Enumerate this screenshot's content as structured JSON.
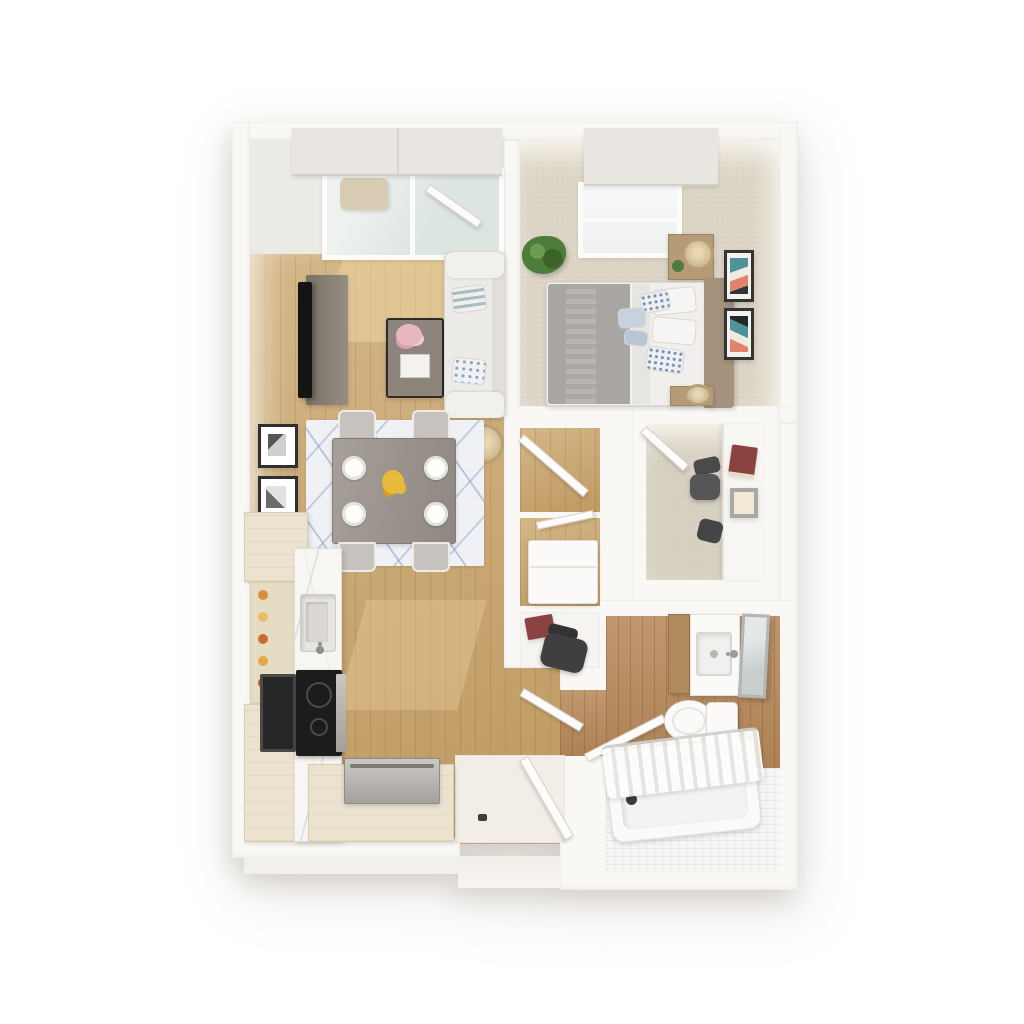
{
  "scene": {
    "type": "3d-floor-plan-render",
    "view": "top-down dollhouse",
    "background_color": "#ffffff"
  },
  "palette": {
    "wall": "#faf8f5",
    "wood_floor": "#c9a266",
    "carpet": "#ddd6c6",
    "den_carpet": "#d7d1c1",
    "bath_wood": "#b8895a",
    "tile": "#f6f6f4",
    "cabinet_cream": "#ebe3d0",
    "marble": "#f7f6f3",
    "rug": "#eff1f4",
    "rug_accent": "#9fb0cc",
    "sofa": "#edebe8",
    "console": "#8a8175",
    "tv": "#141414",
    "dining_table": "#989089",
    "blanket": "#a9a5a2",
    "headboard": "#a5937d",
    "nightstand": "#b49a76",
    "lamp": "#d2bb8f",
    "plant": "#4e7c3a",
    "flowers_dining": "#e8b93c",
    "flowers_coffee": "#e7b7c0",
    "book_red": "#8a4340",
    "art_teal": "#4f9396",
    "art_coral": "#e2836b",
    "stainless": "#b5b1ab",
    "appliance_dark": "#1c1c1c",
    "fixture_white": "#fbfaf9",
    "entry_tile": "#f2eee7",
    "balcony_floor": "#e7e6e0",
    "glass": "#e3e9e6",
    "shade": "#e9e6e2"
  },
  "rooms": [
    {
      "id": "living-room",
      "name": "Living Room",
      "floor": "hardwood"
    },
    {
      "id": "dining-area",
      "name": "Dining Area",
      "floor": "hardwood"
    },
    {
      "id": "kitchen",
      "name": "Kitchen",
      "floor": "hardwood"
    },
    {
      "id": "bedroom",
      "name": "Bedroom",
      "floor": "carpet"
    },
    {
      "id": "den-office",
      "name": "Den / Office",
      "floor": "carpet"
    },
    {
      "id": "closet",
      "name": "Closet",
      "floor": "hardwood"
    },
    {
      "id": "utility-closet",
      "name": "Utility Closet",
      "floor": "hardwood"
    },
    {
      "id": "hallway",
      "name": "Hallway",
      "floor": "hardwood"
    },
    {
      "id": "entry",
      "name": "Entry",
      "floor": "tile"
    },
    {
      "id": "bathroom",
      "name": "Bathroom",
      "floor": "hardwood and tile"
    },
    {
      "id": "balcony",
      "name": "Balcony",
      "floor": "concrete"
    }
  ],
  "furniture": {
    "living_room": [
      "tv-console",
      "tv",
      "coffee-table",
      "sofa",
      "striped-pillows",
      "floor-lamp",
      "two-wall-art-frames",
      "sunlight-patches"
    ],
    "dining_area": [
      "patterned-area-rug",
      "dining-table",
      "four-chairs",
      "four-place-settings",
      "yellow-flower-centerpiece"
    ],
    "kitchen": [
      "upper-cabinet",
      "open-shelf-with-jars",
      "lower-cabinet",
      "marble-counter",
      "sink",
      "wall-oven",
      "cooktop",
      "dishwasher",
      "base-cabinet-run"
    ],
    "bedroom": [
      "bed",
      "gray-blanket",
      "pillows",
      "headboard",
      "two-nightstands",
      "two-table-lamps",
      "potted-plant",
      "two-wall-art-frames",
      "roller-shade-window"
    ],
    "den_office": [
      "desk",
      "office-chair",
      "red-book",
      "framed-box"
    ],
    "utility_closet": [
      "white-appliance"
    ],
    "hallway": [
      "desk-nook",
      "red-book",
      "task-chair",
      "open-door-leaves"
    ],
    "entry": [
      "entry-door",
      "doorstop",
      "stoop"
    ],
    "bathroom": [
      "wood-vanity",
      "sink",
      "leaning-mirror",
      "toilet",
      "bathtub",
      "striped-shower-curtain"
    ],
    "balcony": [
      "lounge-chair",
      "french-door",
      "roller-shade-valances"
    ]
  }
}
